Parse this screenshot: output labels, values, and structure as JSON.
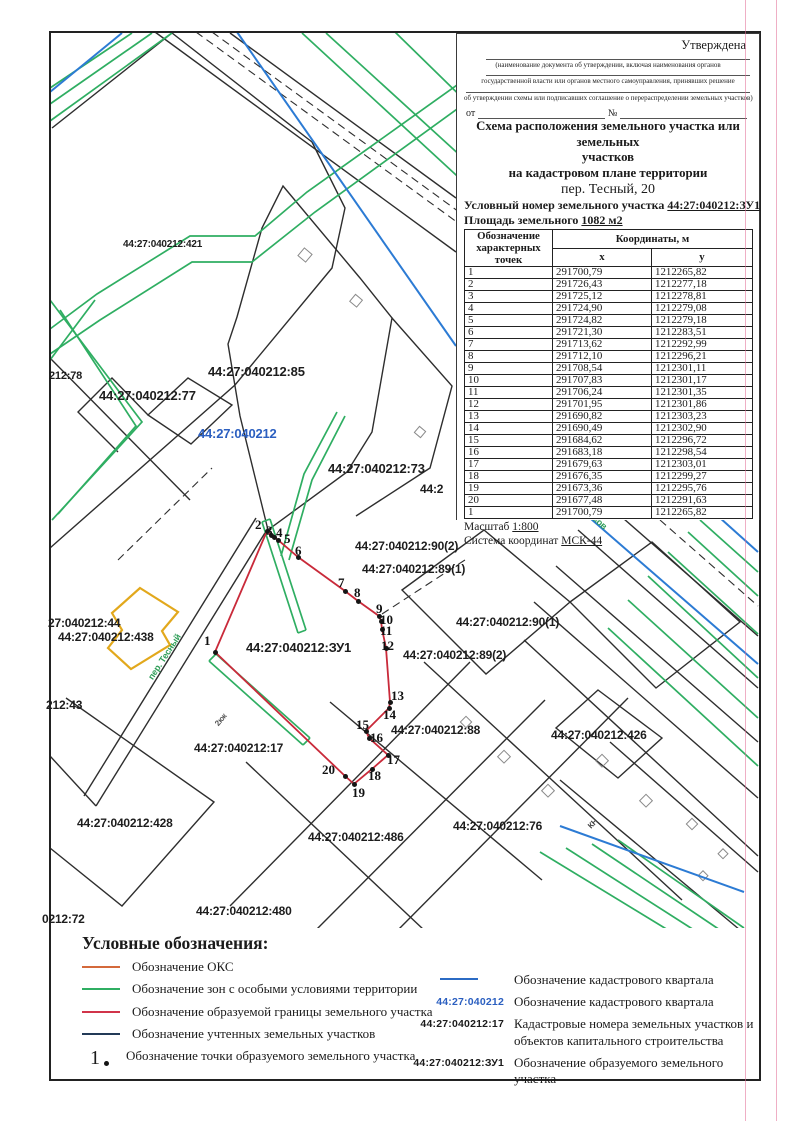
{
  "approval": {
    "approved_label": "Утверждена",
    "line1": "(наименование документа об утверждении, включая наименования органов",
    "line2": "государственной власти или органов местного самоуправления, принявших решение",
    "line3": "об утверждении схемы или подписавших соглашение о перераспределении земельных участков)",
    "from_label": "от",
    "number_label": "№"
  },
  "title": {
    "line1": "Схема расположения земельного участка или земельных",
    "line2": "участков",
    "line3": "на кадастровом плане территории",
    "address": "пер. Тесный, 20",
    "conditional_number_label": "Условный номер земельного участка",
    "conditional_number_value": "44:27:040212:ЗУ1",
    "area_label": "Площадь земельного",
    "area_value": "1082 м2"
  },
  "table": {
    "col1_header": "Обозначение характерных точек",
    "coords_header": "Координаты, м",
    "x_header": "x",
    "y_header": "y",
    "rows": [
      [
        "1",
        "291700,79",
        "1212265,82"
      ],
      [
        "2",
        "291726,43",
        "1212277,18"
      ],
      [
        "3",
        "291725,12",
        "1212278,81"
      ],
      [
        "4",
        "291724,90",
        "1212279,08"
      ],
      [
        "5",
        "291724,82",
        "1212279,18"
      ],
      [
        "6",
        "291721,30",
        "1212283,51"
      ],
      [
        "7",
        "291713,62",
        "1212292,99"
      ],
      [
        "8",
        "291712,10",
        "1212296,21"
      ],
      [
        "9",
        "291708,54",
        "1212301,11"
      ],
      [
        "10",
        "291707,83",
        "1212301,17"
      ],
      [
        "11",
        "291706,24",
        "1212301,35"
      ],
      [
        "12",
        "291701,95",
        "1212301,86"
      ],
      [
        "13",
        "291690,82",
        "1212303,23"
      ],
      [
        "14",
        "291690,49",
        "1212302,90"
      ],
      [
        "15",
        "291684,62",
        "1212296,72"
      ],
      [
        "16",
        "291683,18",
        "1212298,54"
      ],
      [
        "17",
        "291679,63",
        "1212303,01"
      ],
      [
        "18",
        "291676,35",
        "1212299,27"
      ],
      [
        "19",
        "291673,36",
        "1212295,76"
      ],
      [
        "20",
        "291677,48",
        "1212291,63"
      ],
      [
        "1",
        "291700,79",
        "1212265,82"
      ]
    ]
  },
  "scale_label": "Масштаб",
  "scale_value": "1:800",
  "coord_system_label": "Система координат",
  "coord_system_value": "МСК-44",
  "map": {
    "quarter_number": "44:27:040212",
    "parcel_number": "44:27:040212:ЗУ1",
    "labels": [
      {
        "text": "44:27:040212:421",
        "x": 123,
        "y": 239,
        "size": 10
      },
      {
        "text": "212:78",
        "x": 49,
        "y": 370,
        "size": 11
      },
      {
        "text": "44:27:040212:85",
        "x": 208,
        "y": 364,
        "size": 13
      },
      {
        "text": "44:27:040212:77",
        "x": 99,
        "y": 388,
        "size": 13
      },
      {
        "text": "44:27:040212",
        "x": 198,
        "y": 426,
        "size": 13,
        "color": "#2b5fc0"
      },
      {
        "text": "44:27:040212:73",
        "x": 328,
        "y": 461,
        "size": 13
      },
      {
        "text": "44:2",
        "x": 420,
        "y": 482,
        "size": 12
      },
      {
        "text": "44:27:040212:90(2)",
        "x": 355,
        "y": 539,
        "size": 12
      },
      {
        "text": "44:27:040212:89(1)",
        "x": 362,
        "y": 562,
        "size": 12
      },
      {
        "text": "44:27:040212:90(1)",
        "x": 456,
        "y": 615,
        "size": 12
      },
      {
        "text": "44:27:040212:89(2)",
        "x": 403,
        "y": 648,
        "size": 12
      },
      {
        "text": "44:27:040212:ЗУ1",
        "x": 246,
        "y": 640,
        "size": 13
      },
      {
        "text": "27:040212:44",
        "x": 48,
        "y": 616,
        "size": 12
      },
      {
        "text": "44:27:040212:438",
        "x": 58,
        "y": 630,
        "size": 12
      },
      {
        "text": "212:43",
        "x": 46,
        "y": 698,
        "size": 12
      },
      {
        "text": "44:27:040212:17",
        "x": 194,
        "y": 741,
        "size": 12
      },
      {
        "text": "44:27:040212:88",
        "x": 391,
        "y": 723,
        "size": 12
      },
      {
        "text": "44:27:040212:426",
        "x": 551,
        "y": 728,
        "size": 12
      },
      {
        "text": "44:27:040212:76",
        "x": 453,
        "y": 819,
        "size": 12
      },
      {
        "text": "44:27:040212:486",
        "x": 308,
        "y": 830,
        "size": 12
      },
      {
        "text": "44:27:040212:428",
        "x": 77,
        "y": 816,
        "size": 12
      },
      {
        "text": "44:27:040212:480",
        "x": 196,
        "y": 904,
        "size": 12
      },
      {
        "text": "0212:72",
        "x": 42,
        "y": 912,
        "size": 12
      },
      {
        "text": "пер. Тесный",
        "x": 146,
        "y": 676,
        "size": 9,
        "color": "#2f9e58",
        "rotate": -57
      },
      {
        "text": "2кж",
        "x": 213,
        "y": 722,
        "size": 8,
        "color": "#555555",
        "rotate": -50
      },
      {
        "text": "КН",
        "x": 586,
        "y": 824,
        "size": 8,
        "color": "#444444",
        "rotate": -45
      },
      {
        "text": "ков",
        "x": 598,
        "y": 514,
        "size": 9,
        "color": "#2f9e58",
        "rotate": 42
      }
    ],
    "points": [
      {
        "n": "1",
        "dx": 215,
        "dy": 652,
        "lx": 204,
        "ly": 633
      },
      {
        "n": "2",
        "dx": 267,
        "dy": 531,
        "lx": 255,
        "ly": 517
      },
      {
        "n": "3",
        "dx": 271,
        "dy": 535,
        "lx": 266,
        "ly": 523
      },
      {
        "n": "4",
        "dx": 274,
        "dy": 537,
        "lx": 276,
        "ly": 525
      },
      {
        "n": "5",
        "dx": 278,
        "dy": 540,
        "lx": 284,
        "ly": 531
      },
      {
        "n": "6",
        "dx": 298,
        "dy": 557,
        "lx": 295,
        "ly": 543
      },
      {
        "n": "7",
        "dx": 345,
        "dy": 591,
        "lx": 338,
        "ly": 575
      },
      {
        "n": "8",
        "dx": 358,
        "dy": 601,
        "lx": 354,
        "ly": 585
      },
      {
        "n": "9",
        "dx": 379,
        "dy": 616,
        "lx": 376,
        "ly": 601
      },
      {
        "n": "10",
        "dx": 381,
        "dy": 621,
        "lx": 380,
        "ly": 612
      },
      {
        "n": "11",
        "dx": 382,
        "dy": 629,
        "lx": 380,
        "ly": 623
      },
      {
        "n": "12",
        "dx": 386,
        "dy": 648,
        "lx": 381,
        "ly": 638
      },
      {
        "n": "13",
        "dx": 390,
        "dy": 702,
        "lx": 391,
        "ly": 688
      },
      {
        "n": "14",
        "dx": 389,
        "dy": 708,
        "lx": 383,
        "ly": 707
      },
      {
        "n": "15",
        "dx": 366,
        "dy": 731,
        "lx": 356,
        "ly": 717
      },
      {
        "n": "16",
        "dx": 369,
        "dy": 738,
        "lx": 370,
        "ly": 730
      },
      {
        "n": "17",
        "dx": 388,
        "dy": 755,
        "lx": 387,
        "ly": 752
      },
      {
        "n": "18",
        "dx": 372,
        "dy": 769,
        "lx": 368,
        "ly": 768
      },
      {
        "n": "19",
        "dx": 354,
        "dy": 784,
        "lx": 352,
        "ly": 785
      },
      {
        "n": "20",
        "dx": 345,
        "dy": 776,
        "lx": 322,
        "ly": 762
      }
    ]
  },
  "legend": {
    "title": "Условные обозначения:",
    "left": [
      {
        "type": "line",
        "color": "#d4693b",
        "label": "Обозначение ОКС"
      },
      {
        "type": "line",
        "color": "#2fae62",
        "label": "Обозначение зон с особыми условиями территории"
      },
      {
        "type": "line",
        "color": "#d1344a",
        "label": "Обозначение образуемой границы земельного участка"
      },
      {
        "type": "line",
        "color": "#233a57",
        "label": "Обозначение учтенных земельных участков"
      },
      {
        "type": "point",
        "symbol": "1",
        "label": "Обозначение точки образуемого земельного участка"
      }
    ],
    "right": [
      {
        "type": "line",
        "color": "#2b6bc4",
        "label": "Обозначение кадастрового квартала"
      },
      {
        "type": "code",
        "code": "44:27:040212",
        "color": "#2b5fc0",
        "label": "Обозначение кадастрового квартала"
      },
      {
        "type": "code",
        "code": "44:27:040212:17",
        "color": "#1b1b1b",
        "label": "Кадастровые номера земельных участков и объектов капитального строительства"
      },
      {
        "type": "code",
        "code": "44:27:040212:ЗУ1",
        "color": "#1b1b1b",
        "label": "Обозначение образуемого земельного участка"
      }
    ]
  }
}
